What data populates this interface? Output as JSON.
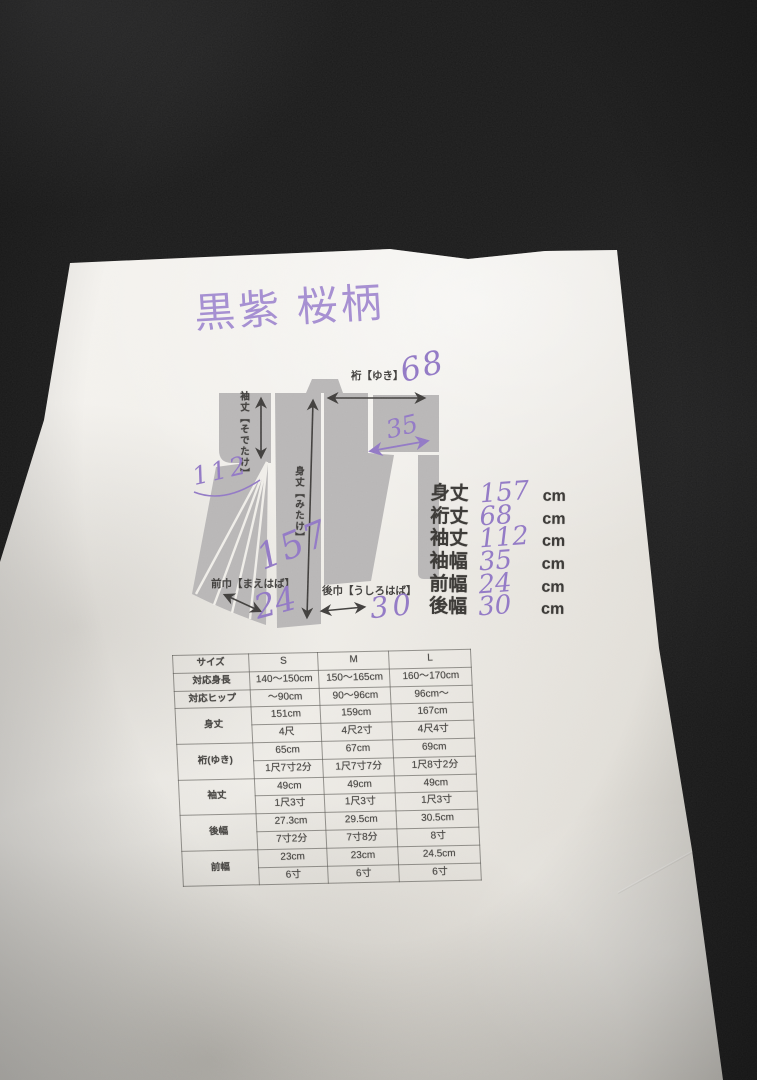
{
  "photo": {
    "fabric_color": "#151515",
    "paper_color": "#f0ede8",
    "ink_color": "#8e74c3"
  },
  "title": {
    "text": "黒紫 桜柄"
  },
  "diagram": {
    "silhouette_color": "#b6b4b4",
    "labels": {
      "yuki": "裄【ゆき】",
      "sodetake": "袖丈【そでたけ】",
      "mitake": "身丈【みたけ】",
      "maehaba": "前巾【まえはば】",
      "ushirohaba": "後巾【うしろはば】"
    },
    "annotations": {
      "yuki": "68",
      "sodehaba": "35",
      "sodetake": "112",
      "mitake": "157",
      "maehaba": "24",
      "ushirohaba": "30"
    }
  },
  "measurements": {
    "unit": "cm",
    "items": [
      {
        "label": "身丈",
        "value": "157"
      },
      {
        "label": "裄丈",
        "value": "68"
      },
      {
        "label": "袖丈",
        "value": "112"
      },
      {
        "label": "袖幅",
        "value": "35"
      },
      {
        "label": "前幅",
        "value": "24"
      },
      {
        "label": "後幅",
        "value": "30"
      }
    ]
  },
  "size_table": {
    "headers": [
      "サイズ",
      "S",
      "M",
      "L"
    ],
    "rows": [
      {
        "label": "対応身長",
        "values": [
          "140～150cm",
          "150～165cm",
          "160～170cm"
        ]
      },
      {
        "label": "対応ヒップ",
        "values": [
          "～90cm",
          "90～96cm",
          "96cm～"
        ]
      },
      {
        "label": "身丈",
        "cm": [
          "151cm",
          "159cm",
          "167cm"
        ],
        "shaku": [
          "4尺",
          "4尺2寸",
          "4尺4寸"
        ]
      },
      {
        "label": "裄(ゆき)",
        "cm": [
          "65cm",
          "67cm",
          "69cm"
        ],
        "shaku": [
          "1尺7寸2分",
          "1尺7寸7分",
          "1尺8寸2分"
        ]
      },
      {
        "label": "袖丈",
        "cm": [
          "49cm",
          "49cm",
          "49cm"
        ],
        "shaku": [
          "1尺3寸",
          "1尺3寸",
          "1尺3寸"
        ]
      },
      {
        "label": "後幅",
        "cm": [
          "27.3cm",
          "29.5cm",
          "30.5cm"
        ],
        "shaku": [
          "7寸2分",
          "7寸8分",
          "8寸"
        ]
      },
      {
        "label": "前幅",
        "cm": [
          "23cm",
          "23cm",
          "24.5cm"
        ],
        "shaku": [
          "6寸",
          "6寸",
          "6寸"
        ]
      }
    ]
  }
}
